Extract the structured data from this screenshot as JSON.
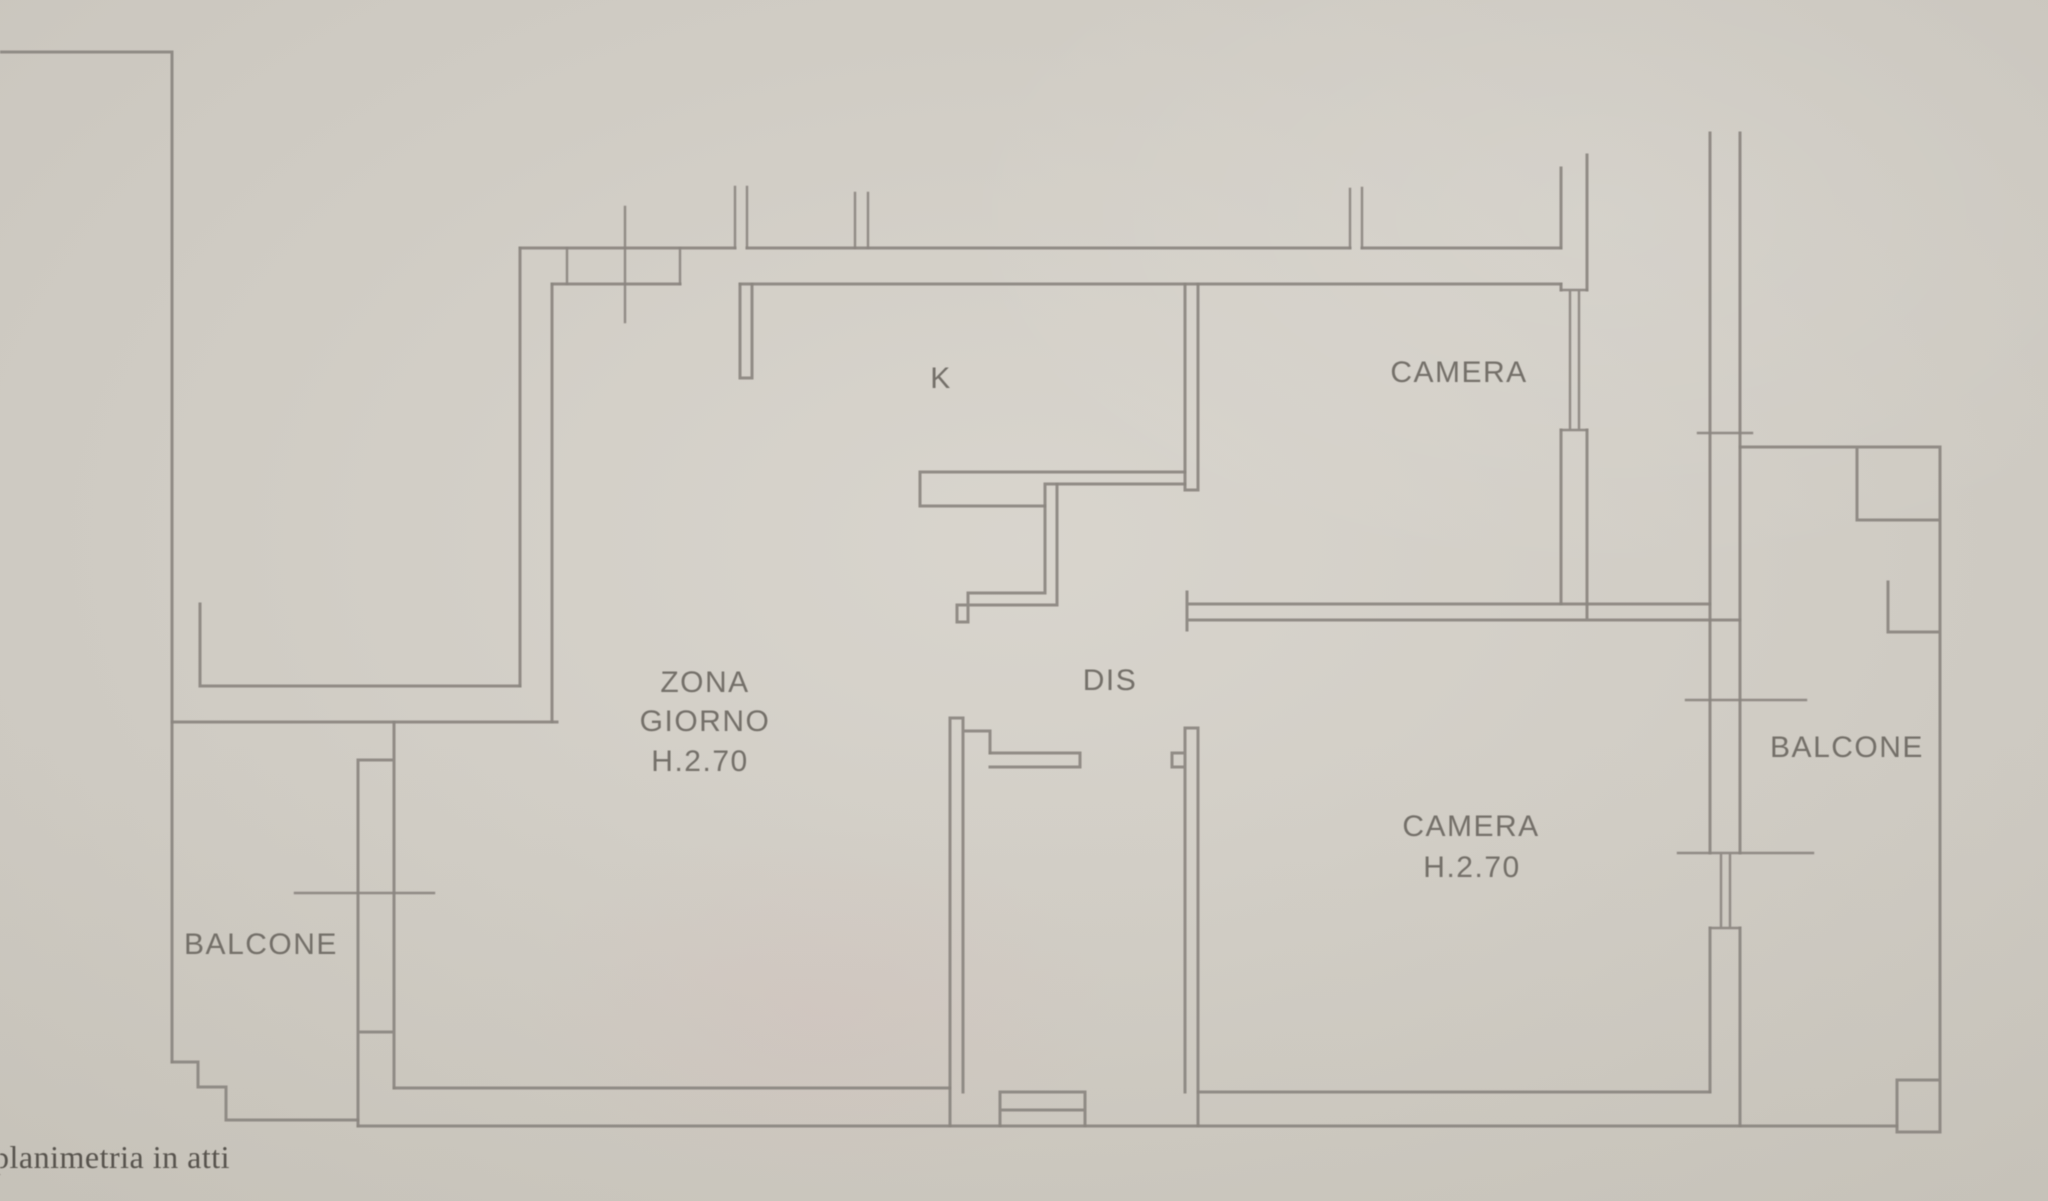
{
  "photo": {
    "paper_color": "#d6d2ca",
    "line_color": "#8b8680",
    "label_color": "#6e6a63",
    "caption_color": "#57534d"
  },
  "floorplan": {
    "rooms": [
      {
        "id": "zona-giorno",
        "label": "ZONA GIORNO",
        "label_lines": [
          "ZONA",
          "GIORNO"
        ],
        "height_note": "H.2.70"
      },
      {
        "id": "cucina",
        "label": "K"
      },
      {
        "id": "disimpegno",
        "label": "DIS"
      },
      {
        "id": "camera-nord",
        "label": "CAMERA"
      },
      {
        "id": "camera-sud",
        "label": "CAMERA",
        "height_note": "H.2.70"
      },
      {
        "id": "balcone-ovest",
        "label": "BALCONE"
      },
      {
        "id": "balcone-est",
        "label": "BALCONE"
      }
    ],
    "caption": "planimetria in atti"
  }
}
